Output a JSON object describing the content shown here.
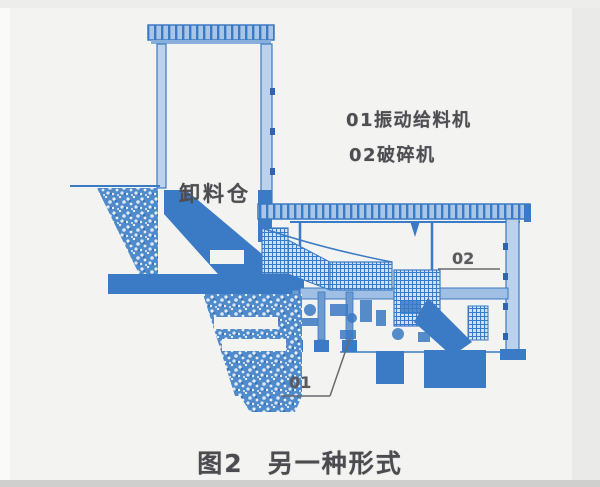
{
  "figure": {
    "caption": {
      "fig_no": "图2",
      "title": "另一种形式"
    },
    "annotations": {
      "legend_item_1": "01振动给料机",
      "legend_item_2": "02破碎机",
      "hopper_label": "卸料仓",
      "callout_01": "01",
      "callout_02": "02"
    },
    "colors": {
      "ink_blue": "#3b7ac4",
      "ink_blue_dark": "#2e66ad",
      "ink_blue_light": "#bcd2ec",
      "paper": "#f3f3f1",
      "text_gray": "#4d4d52"
    }
  }
}
